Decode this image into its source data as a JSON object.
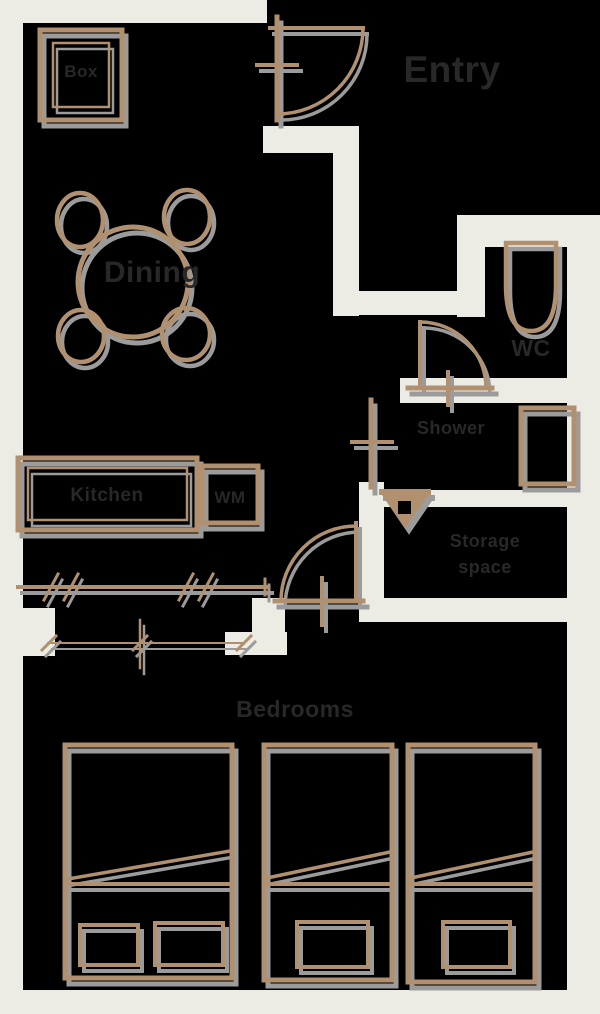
{
  "title": "Apartment floor plan",
  "colors": {
    "background": "#000000",
    "wall": "#edece4",
    "furniture_line": "#b1906f",
    "shadow": "#9b9b9b",
    "label_text": "#282828"
  },
  "labels": {
    "entry": "Entry",
    "storage_box": "Box",
    "dining": "Dining",
    "kitchen": "Kitchen",
    "appliance": "WM",
    "toilet": "WC",
    "shower": "Shower",
    "storage_line1": "Storage",
    "storage_line2": "space",
    "bedrooms": "Bedrooms"
  }
}
